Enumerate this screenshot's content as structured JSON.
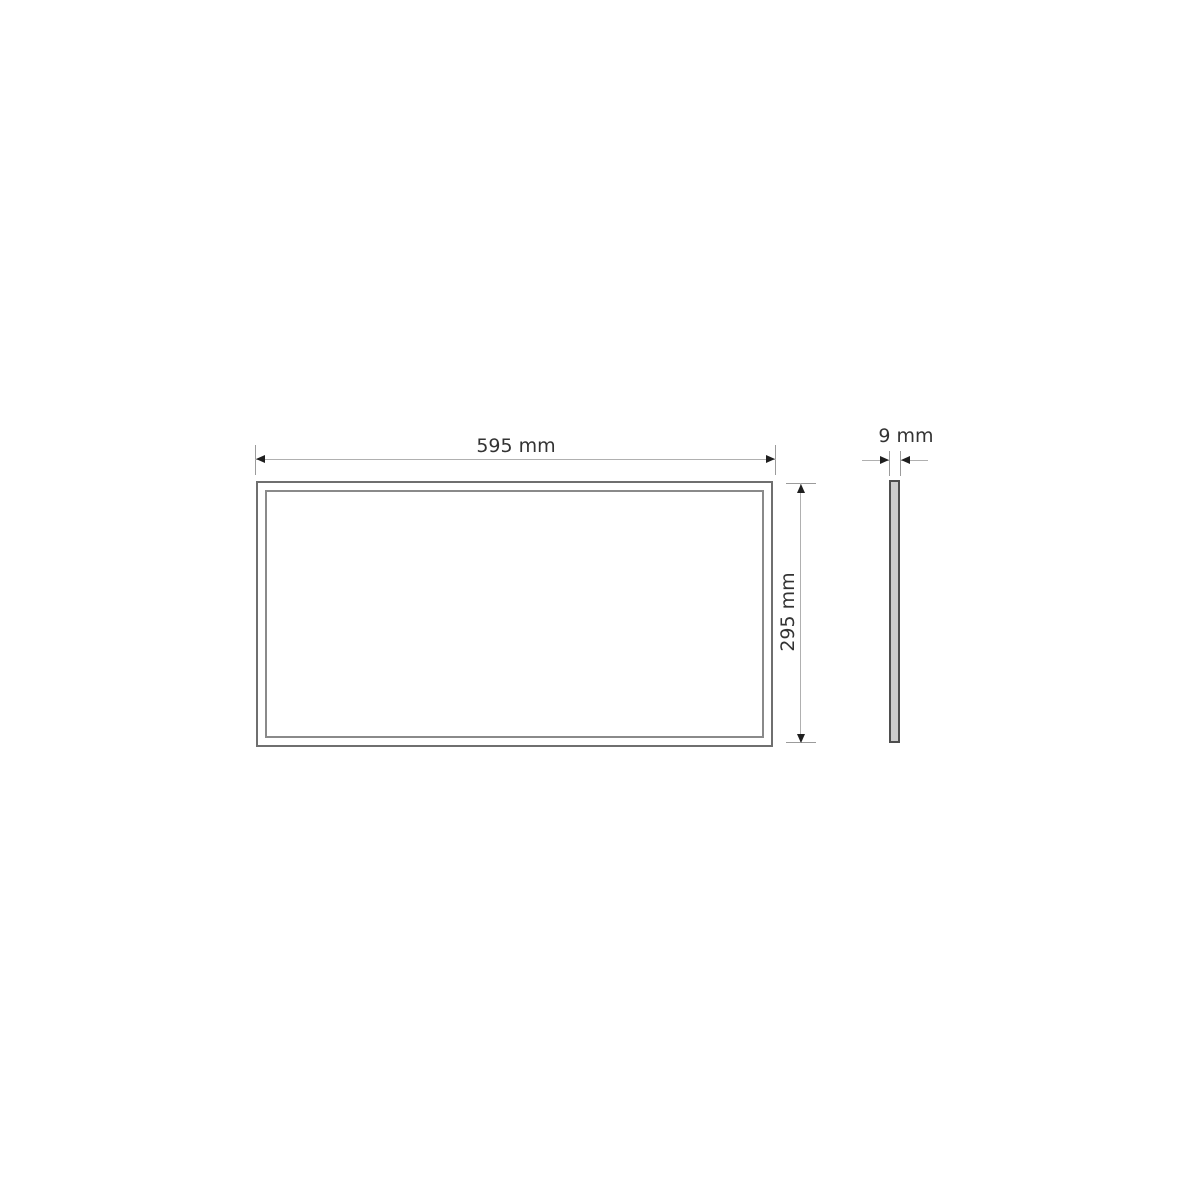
{
  "page": {
    "title": "Panel dimension drawing",
    "background": "#ffffff"
  },
  "diagram": {
    "type": "technical-dimension-drawing",
    "subject": "flat rectangular panel shown in front view and side profile",
    "views": {
      "front": {
        "name": "front-view",
        "width_dim": {
          "label": "595 mm",
          "value": 595,
          "unit": "mm"
        },
        "height_dim": {
          "label": "295 mm",
          "value": 295,
          "unit": "mm"
        }
      },
      "side": {
        "name": "side-profile",
        "thickness_dim": {
          "label": "9 mm",
          "value": 9,
          "unit": "mm"
        }
      }
    },
    "colors": {
      "outline": "#6f6f6f",
      "inner_outline": "#8a8a8a",
      "dimension_line": "#b0b0b0",
      "extension_line": "#9b9b9b",
      "arrow": "#1f1f1f",
      "text": "#333333",
      "side_panel_fill": "#cdcdcd",
      "side_panel_border": "#4e4e4e",
      "background": "#ffffff"
    }
  }
}
